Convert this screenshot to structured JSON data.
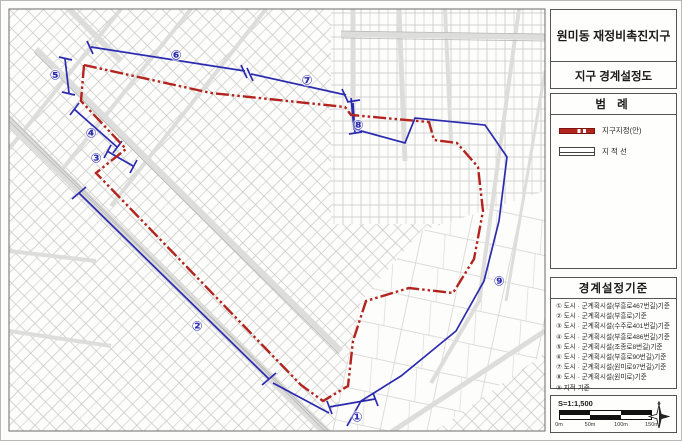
{
  "title_panel": {
    "title": "원미동 재정비촉진지구",
    "subtitle": "지구 경계설정도"
  },
  "legend": {
    "header": "범 례",
    "items": [
      {
        "name": "district-designation-boundary",
        "label": "지구지정(안)",
        "swatch": "red-dashed-line",
        "color": "#b3241e"
      },
      {
        "name": "cadastral-line",
        "label": "지 적 선",
        "swatch": "thin-black-line",
        "color": "#44433f"
      }
    ]
  },
  "criteria": {
    "header": "경계설정기준",
    "items": [
      "① 도시 · 군계획시설(부흥로467번길)기준",
      "② 도시 · 군계획시설(부흥로)기준",
      "③ 도시 · 군계획시설(수주로401번길)기준",
      "④ 도시 · 군계획시설(부흥로486번길)기준",
      "⑤ 도시 · 군계획시설(조종로8번길)기준",
      "⑥ 도시 · 군계획시설(부흥로90번길)기준",
      "⑦ 도시 · 군계획시설(원미로97번길)기준",
      "⑧ 도시 · 군계획시설(원미로)기준",
      "⑨ 지적 기준"
    ]
  },
  "scale": {
    "text": "S=1:1,500",
    "ticks": [
      "0m",
      "50m",
      "100m",
      "150m"
    ],
    "compass": "north-star"
  },
  "map": {
    "markers": [
      {
        "id": "1",
        "glyph": "①",
        "x": 356,
        "y": 416
      },
      {
        "id": "2",
        "glyph": "②",
        "x": 196,
        "y": 325
      },
      {
        "id": "3",
        "glyph": "③",
        "x": 95,
        "y": 157
      },
      {
        "id": "4",
        "glyph": "④",
        "x": 90,
        "y": 132
      },
      {
        "id": "5",
        "glyph": "⑤",
        "x": 54,
        "y": 74
      },
      {
        "id": "6",
        "glyph": "⑥",
        "x": 175,
        "y": 54
      },
      {
        "id": "7",
        "glyph": "⑦",
        "x": 306,
        "y": 79
      },
      {
        "id": "8",
        "glyph": "⑧",
        "x": 357,
        "y": 124
      },
      {
        "id": "9",
        "glyph": "⑨",
        "x": 498,
        "y": 280
      }
    ]
  },
  "colors": {
    "boundary_red": "#b3241e",
    "dimension_blue": "#2b2bb0",
    "parcel_gray": "#bdbdbd",
    "street_gray": "#d9d9d6"
  }
}
